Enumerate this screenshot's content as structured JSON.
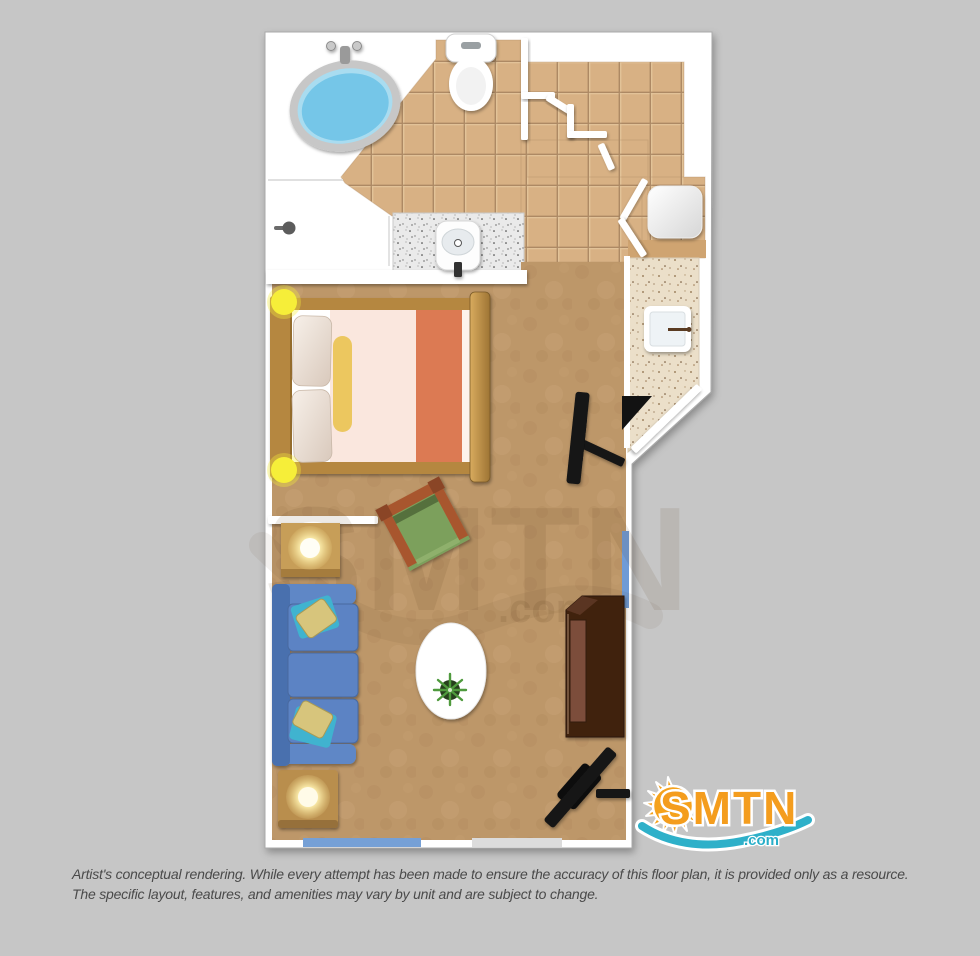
{
  "page": {
    "background_color": "#c6c6c6",
    "type_of_image": "floor-plan-rendering"
  },
  "watermark": {
    "text": "SMTN",
    "suffix": ".com"
  },
  "logo": {
    "text": "SMTN",
    "suffix": ".com",
    "colors": {
      "orange": "#f49d1e",
      "teal": "#2eb0c9",
      "outline": "#ffffff"
    }
  },
  "disclaimer": {
    "line1": "Artist's conceptual rendering. While every attempt has been made to ensure the accuracy of this floor plan, it is provided only as a resource.",
    "line2": "The specific layout, features, and amenities may vary by unit and are subject to change."
  },
  "floorplan": {
    "rooms": [
      "bathroom",
      "shower-room",
      "hallway-closets",
      "bedroom",
      "kitchenette",
      "entry",
      "living-area"
    ],
    "fixtures": [
      "bathtub",
      "toilet",
      "shower-control",
      "vanity-sink",
      "closet-fixture",
      "kitchenette-sink",
      "bed",
      "pillows",
      "bolster-pillow",
      "wall-sconce",
      "room-divider-wall",
      "side-table-lamp",
      "sofa",
      "throw-pillows",
      "armchair",
      "area-rug",
      "potted-plant",
      "dresser",
      "wall-tv",
      "entry-door",
      "window"
    ],
    "colors": {
      "wall": "#ffffff",
      "tile_floor": "#d8b184",
      "carpet": "#bd9769",
      "counter_speckle": "#ebdfc9",
      "vanity_speckle": "#eaeaea",
      "tub_water": "#74c6e8",
      "sofa_blue": "#5b83c4",
      "bed_sheet": "#fae7de",
      "bed_stripe_orange": "#dc7a52",
      "bolster_yellow": "#ecc75f",
      "wood": "#b5873f",
      "armchair_green": "#7ba05c",
      "armchair_frame": "#a8562e",
      "dresser_brown": "#40220f",
      "window_blue": "#76a0d6",
      "sconce_yellow": "#f6ee39",
      "tv_black": "#141414"
    }
  }
}
